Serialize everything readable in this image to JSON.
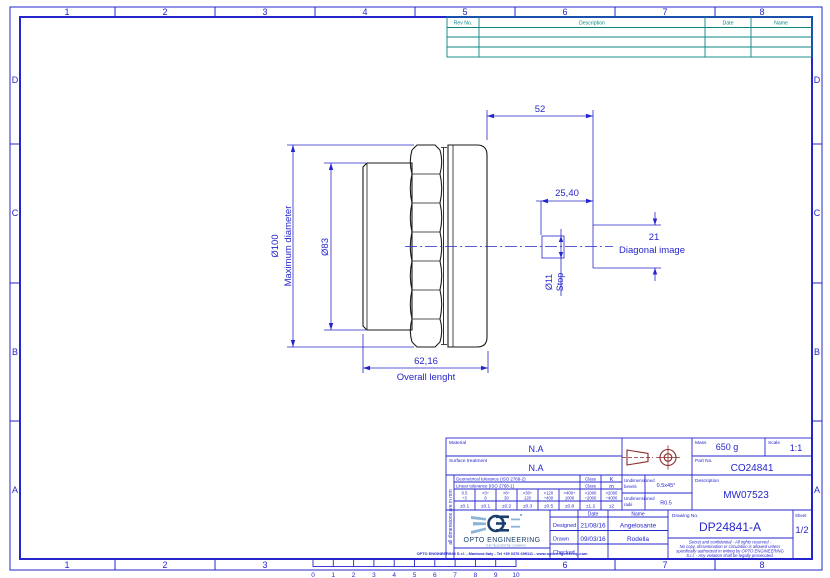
{
  "frame": {
    "columns": [
      "1",
      "2",
      "3",
      "4",
      "5",
      "6",
      "7",
      "8"
    ],
    "rows": [
      "D",
      "C",
      "B",
      "A"
    ]
  },
  "ruler": {
    "marks": [
      "0",
      "1",
      "2",
      "3",
      "4",
      "5",
      "6",
      "7",
      "8",
      "9",
      "10"
    ]
  },
  "revision_table": {
    "headers": {
      "rev_no": "Rev No.",
      "description": "Description",
      "date": "Date",
      "name": "Name"
    }
  },
  "drawing": {
    "dim_52": "52",
    "dim_2540": "25,40",
    "dim_21": "21",
    "diagonal_label": "Diagonal image",
    "dim_d11": "Ø11",
    "stop_label": "Stop",
    "dim_d100": "Ø100",
    "max_diameter_label": "Maximum diameter",
    "dim_d83": "Ø83",
    "dim_6216": "62,16",
    "overall_label": "Overall lenght"
  },
  "title_block": {
    "material_label": "Material",
    "material_value": "N.A",
    "surface_label": "Surface treatment",
    "surface_value": "N.A",
    "mass_label": "Mass",
    "mass_value": "650 g",
    "scale_label": "Scale",
    "scale_value": "1:1",
    "part_no_label": "Part No.",
    "part_no_value": "CO24841",
    "description_label": "Description",
    "description_value": "MW07523",
    "drawing_no_label": "Drawing No.",
    "drawing_no_value": "DP24841-A",
    "sheet_label": "Sheet",
    "sheet_value": "1/2",
    "geom_tolerance_label": "Geometrical tolerance (ISO 2768-2)",
    "linear_tolerance_label": "Linear tolerance (ISO 2768-1)",
    "class_label": "Class",
    "geom_class_value": "K",
    "linear_class_value": "m",
    "ranges": [
      {
        "a": "0.5",
        "b": "÷3"
      },
      {
        "a": ">3÷",
        "b": "6"
      },
      {
        "a": ">6÷",
        "b": "30"
      },
      {
        "a": ">30÷",
        "b": "120"
      },
      {
        "a": ">120",
        "b": "÷400"
      },
      {
        "a": ">400÷",
        "b": "1000"
      },
      {
        "a": ">1000",
        "b": "÷2000"
      },
      {
        "a": ">2000",
        "b": "÷4000"
      }
    ],
    "tolerances": [
      "±0.1",
      "±0.1",
      "±0.2",
      "±0.3",
      "±0.5",
      "±0.8",
      "±1.2",
      "±2"
    ],
    "bevels_label_1": "Undimensioned",
    "bevels_label_2": "bevels",
    "bevels_value": "0.5x45°",
    "radii_label_1": "Undimensioned",
    "radii_label_2": "radii",
    "radii_value": "R0.5",
    "units_note": "all dimensions are in mm",
    "date_header": "Date",
    "name_header": "Name",
    "designed_label": "Designed",
    "designed_date": "21/08/16",
    "designed_name": "Angelosante",
    "drawn_label": "Drawn",
    "drawn_date": "09/03/16",
    "drawn_name": "Rodella",
    "checked_label": "Checked",
    "confidential": [
      "Secret and confidential - All rights reserved -",
      "No copy, dissemination or circulation is allowed unless",
      "specifically authorized in writing by OPTO ENGINEERING",
      "S.r.l. - Any violation shall be legally prosecuted."
    ],
    "company_footer": "OPTO ENGINEERING S.r.l.  -  Mantova Italy -  Tel +39 0376 699111  -  www.opto-engineering.com",
    "logo_text": "OPTO ENGINEERING",
    "logo_tagline": "THE TELECENTRIC COMPANY"
  },
  "colors": {
    "line_blue": "#2525cc",
    "table_teal": "#0a8686",
    "part_black": "#1a1a1a",
    "projection_red": "#8b2a2a",
    "logo_dark_blue": "#1b3f6e",
    "logo_light_blue": "#8ab4d8"
  }
}
